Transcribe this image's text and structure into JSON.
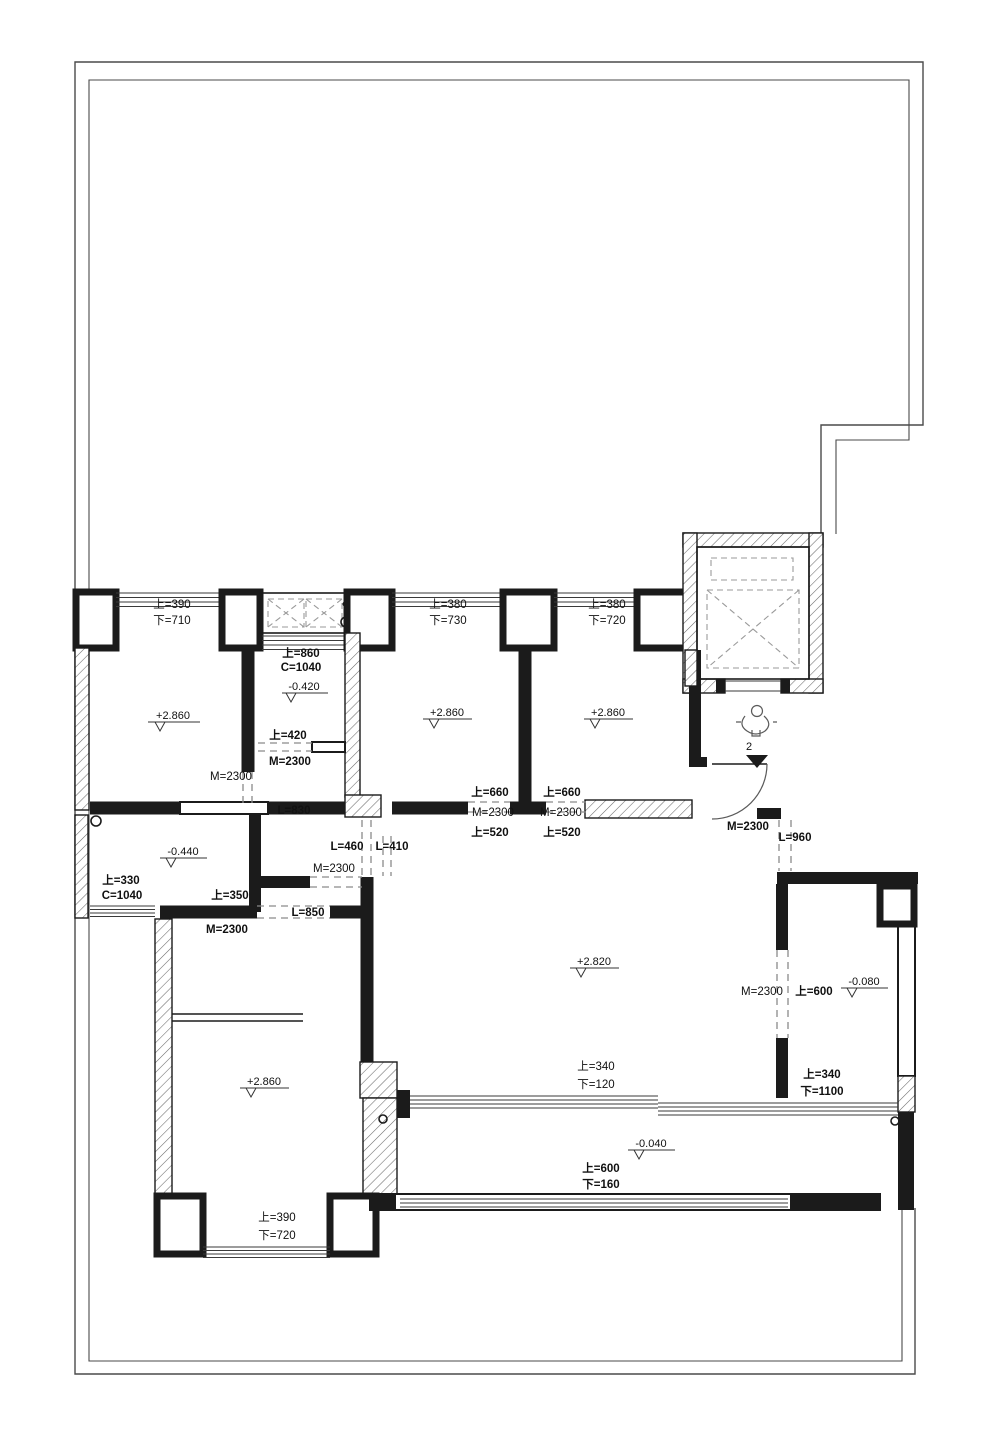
{
  "drawing": {
    "kind": "residential floor plan",
    "colors": {
      "wall": "#1b1b1b",
      "boundary": "#4a4a4a",
      "window": "#3a3a3a",
      "dashed": "#8a8a8a",
      "text": "#111111",
      "background": "#ffffff"
    }
  },
  "levels": {
    "room_top_left": "+2.860",
    "bath_top": "-0.420",
    "room_top_mid": "+2.860",
    "room_top_right": "+2.860",
    "bath_left": "-0.440",
    "living": "+2.820",
    "room_right": "-0.080",
    "balcony": "-0.040",
    "room_bottom_left": "+2.860"
  },
  "windows": {
    "top_left": {
      "up": "上=390",
      "down": "下=710"
    },
    "top_mid": {
      "up": "上=380",
      "down": "下=730"
    },
    "top_right": {
      "up": "上=380",
      "down": "下=720"
    },
    "bath_top": {
      "up": "上=860",
      "c": "C=1040"
    },
    "bath_left": {
      "up": "上=330",
      "c": "C=1040"
    },
    "south": {
      "up": "上=340",
      "down": "下=120"
    },
    "balcony": {
      "up": "上=600",
      "down": "下=160"
    },
    "room_right": {
      "up": "上=340",
      "down": "下=1100"
    },
    "bottom_left": {
      "up": "上=390",
      "down": "下=720"
    }
  },
  "doors": {
    "room_top_left": "M=2300",
    "bath_top_up": "上=420",
    "bath_top": "M=2300",
    "room_top_mid_up": "上=660",
    "room_top_mid": "M=2300",
    "room_top_mid_low": "上=520",
    "room_top_right_up": "上=660",
    "room_top_right": "M=2300",
    "room_top_right_low": "上=520",
    "hall": "M=2300",
    "bath_left_up": "上=350",
    "bath_left": "M=2300",
    "entry": "M=2300",
    "room_right": "M=2300",
    "room_right_up": "上=600"
  },
  "openings": {
    "l830": "L=830",
    "l460": "L=460",
    "l410": "L=410",
    "l850": "L=850",
    "l960": "L=960"
  },
  "markers": {
    "entry_point": "2"
  }
}
